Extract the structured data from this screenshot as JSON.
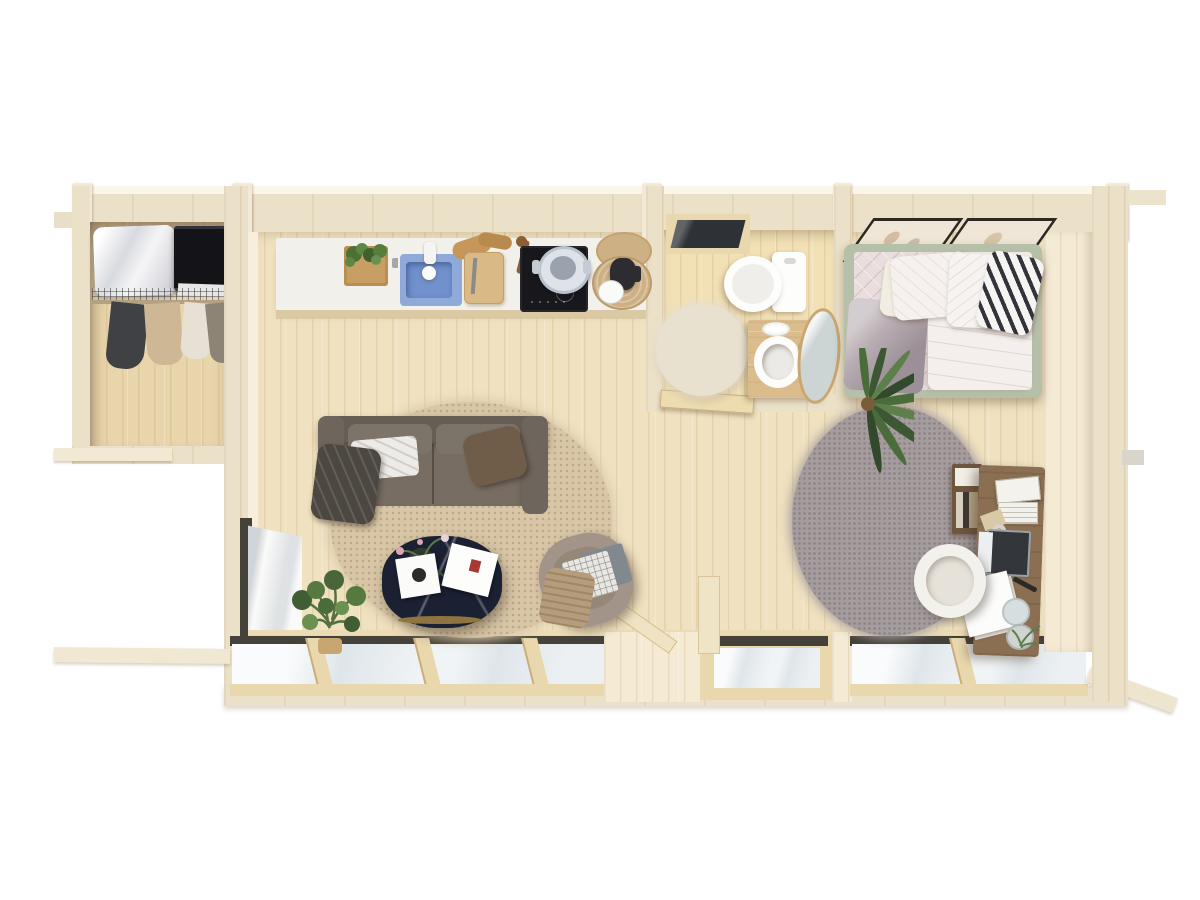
{
  "scene": {
    "name": "log-cabin-top-down-floor-plan-3d-render",
    "background": "#ffffff"
  },
  "rooms": [
    {
      "id": "storage",
      "name": "storage-closet"
    },
    {
      "id": "kitchen",
      "name": "kitchenette"
    },
    {
      "id": "living",
      "name": "living-area"
    },
    {
      "id": "bathroom",
      "name": "bathroom"
    },
    {
      "id": "bedroom",
      "name": "sleeping-area"
    },
    {
      "id": "office",
      "name": "desk-workspace"
    }
  ],
  "furniture": {
    "storage": [
      "duvet-storage-bag",
      "black-storage-boxes",
      "wire-shelf",
      "hanging-clothes-rail"
    ],
    "kitchen": [
      "herb-planter",
      "blue-sink",
      "faucet",
      "cutting-board",
      "bread",
      "induction-hob",
      "steel-pot",
      "woven-trays",
      "coffee-pot",
      "cup"
    ],
    "living": [
      "sofa",
      "white-blanket",
      "dark-throw",
      "brown-pillow",
      "round-jute-rug",
      "marble-coffee-table",
      "magazines",
      "flower-vase",
      "armchair",
      "laptop",
      "fringed-blanket",
      "potted-plant",
      "side-window"
    ],
    "bathroom": [
      "skylight",
      "toilet",
      "vanity-with-basin",
      "soap-dish",
      "leaning-round-mirror",
      "round-rug",
      "open-door"
    ],
    "bedroom": [
      "double-bed-sage-frame",
      "quilted-bedspread",
      "pillows",
      "chevron-pillow",
      "two-wall-pictures",
      "palm-plant",
      "round-grey-rug"
    ],
    "office": [
      "wall-desk",
      "book-shelf-unit",
      "desk-laptop",
      "paper-tray",
      "notebooks",
      "papers",
      "pen",
      "water-glass",
      "cup",
      "white-chair"
    ]
  },
  "windows": {
    "front_glazing_sections": 3,
    "front_mullions": 4,
    "side_window": 1,
    "bathroom_skylight": 1
  },
  "colors": {
    "background": "#ffffff",
    "wall_top": "#ebe0c8",
    "wall_post": "#f2ead6",
    "wall_face": "#f5ebd5",
    "floor": "#f0e2c0",
    "floor_storage": "#e9d5ac",
    "floor_bath": "#f2e0b6",
    "threshold": "#ecdcb6",
    "counter": "#f2f0ea",
    "sink": "#8fa9d8",
    "hob": "#17171c",
    "tray": "#cdb083",
    "rug_living": "#d8c6a6",
    "rug_bedroom": "#a59c9d",
    "rug_bath": "#e9e1d0",
    "sofa": "#776d63",
    "sofa_dark": "#665d54",
    "throw_dark": "#4c4841",
    "pillow_brown": "#6f5c49",
    "table_dark": "#1b2133",
    "table_gold": "#8f7440",
    "armchair": "#a29488",
    "plant": "#47633a",
    "bed_frame": "#b6bfa8",
    "bedding": "#f2ebe8",
    "desk": "#8b6f53",
    "shelf": "#6f563f",
    "chair_white": "#f3f1ec",
    "glass": "#dfe6ea",
    "frame_dark": "#45423a",
    "mullion": "#e9d7ae",
    "door": "#eedcb1",
    "vanity": "#dbbc8d",
    "toilet": "#fdfdfc",
    "mirror": "#cdd4d4",
    "skylight": "#2e3236",
    "box_black": "#141418",
    "duvet_bag": "#f2f2f2",
    "clothes_dark": "#3f4144",
    "clothes_tan": "#cdb795",
    "picture_frame": "#2c2822",
    "picture_paper": "#efe6d7"
  }
}
